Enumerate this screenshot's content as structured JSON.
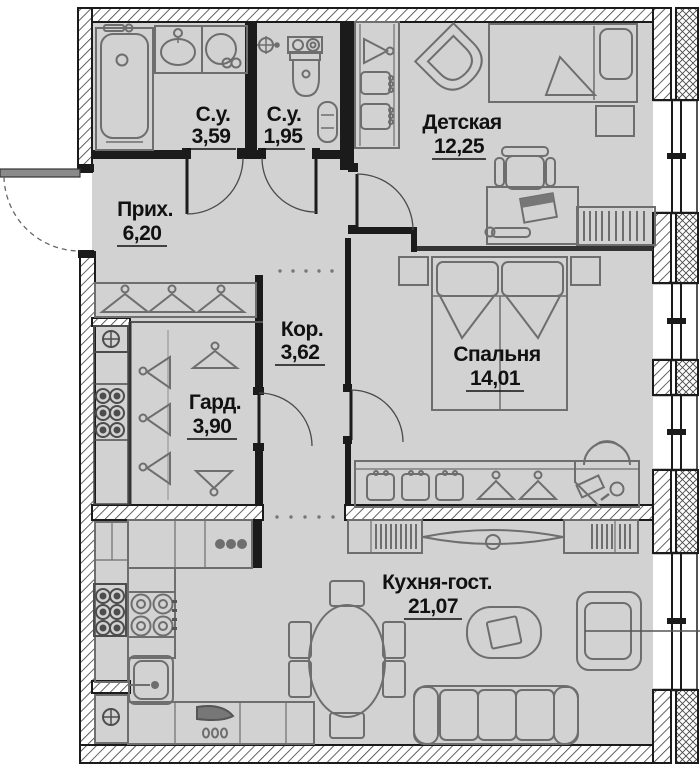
{
  "plan": {
    "type": "apartment-floor-plan",
    "rooms": [
      {
        "name": "bathroom-main",
        "label": "С.у.",
        "area": "3,59"
      },
      {
        "name": "bathroom-small",
        "label": "С.у.",
        "area": "1,95"
      },
      {
        "name": "children-room",
        "label": "Детская",
        "area": "12,25"
      },
      {
        "name": "hallway",
        "label": "Прих.",
        "area": "6,20"
      },
      {
        "name": "corridor",
        "label": "Кор.",
        "area": "3,62"
      },
      {
        "name": "wardrobe",
        "label": "Гард.",
        "area": "3,90"
      },
      {
        "name": "bedroom",
        "label": "Спальня",
        "area": "14,01"
      },
      {
        "name": "kitchen-living",
        "label": "Кухня-гост.",
        "area": "21,07"
      }
    ],
    "icons": [
      "bathtub-icon",
      "washbasin-icon",
      "washing-machine-icon",
      "toilet-icon",
      "towel-dryer-icon",
      "ceiling-light-icon",
      "hanger-icon",
      "vent-shaft-icon",
      "single-bed-icon",
      "double-bed-icon",
      "nightstand-icon",
      "desk-icon",
      "office-chair-icon",
      "bookshelf-icon",
      "corner-chair-icon",
      "wardrobe-boxes-icon",
      "vanity-icon",
      "tv-icon",
      "media-shelf-icon",
      "coffee-table-icon",
      "armchair-icon",
      "sofa-icon",
      "dining-table-icon",
      "chair-icon",
      "stove-icon",
      "kitchen-sink-icon",
      "hood-icon",
      "door-arc",
      "window",
      "wall-hatch"
    ],
    "colors": {
      "background": "#ffffff",
      "floor": "#d2d2d2",
      "wall": "#1b1b1b",
      "furniture_stroke": "#6e6e6e",
      "text": "#111111"
    }
  }
}
